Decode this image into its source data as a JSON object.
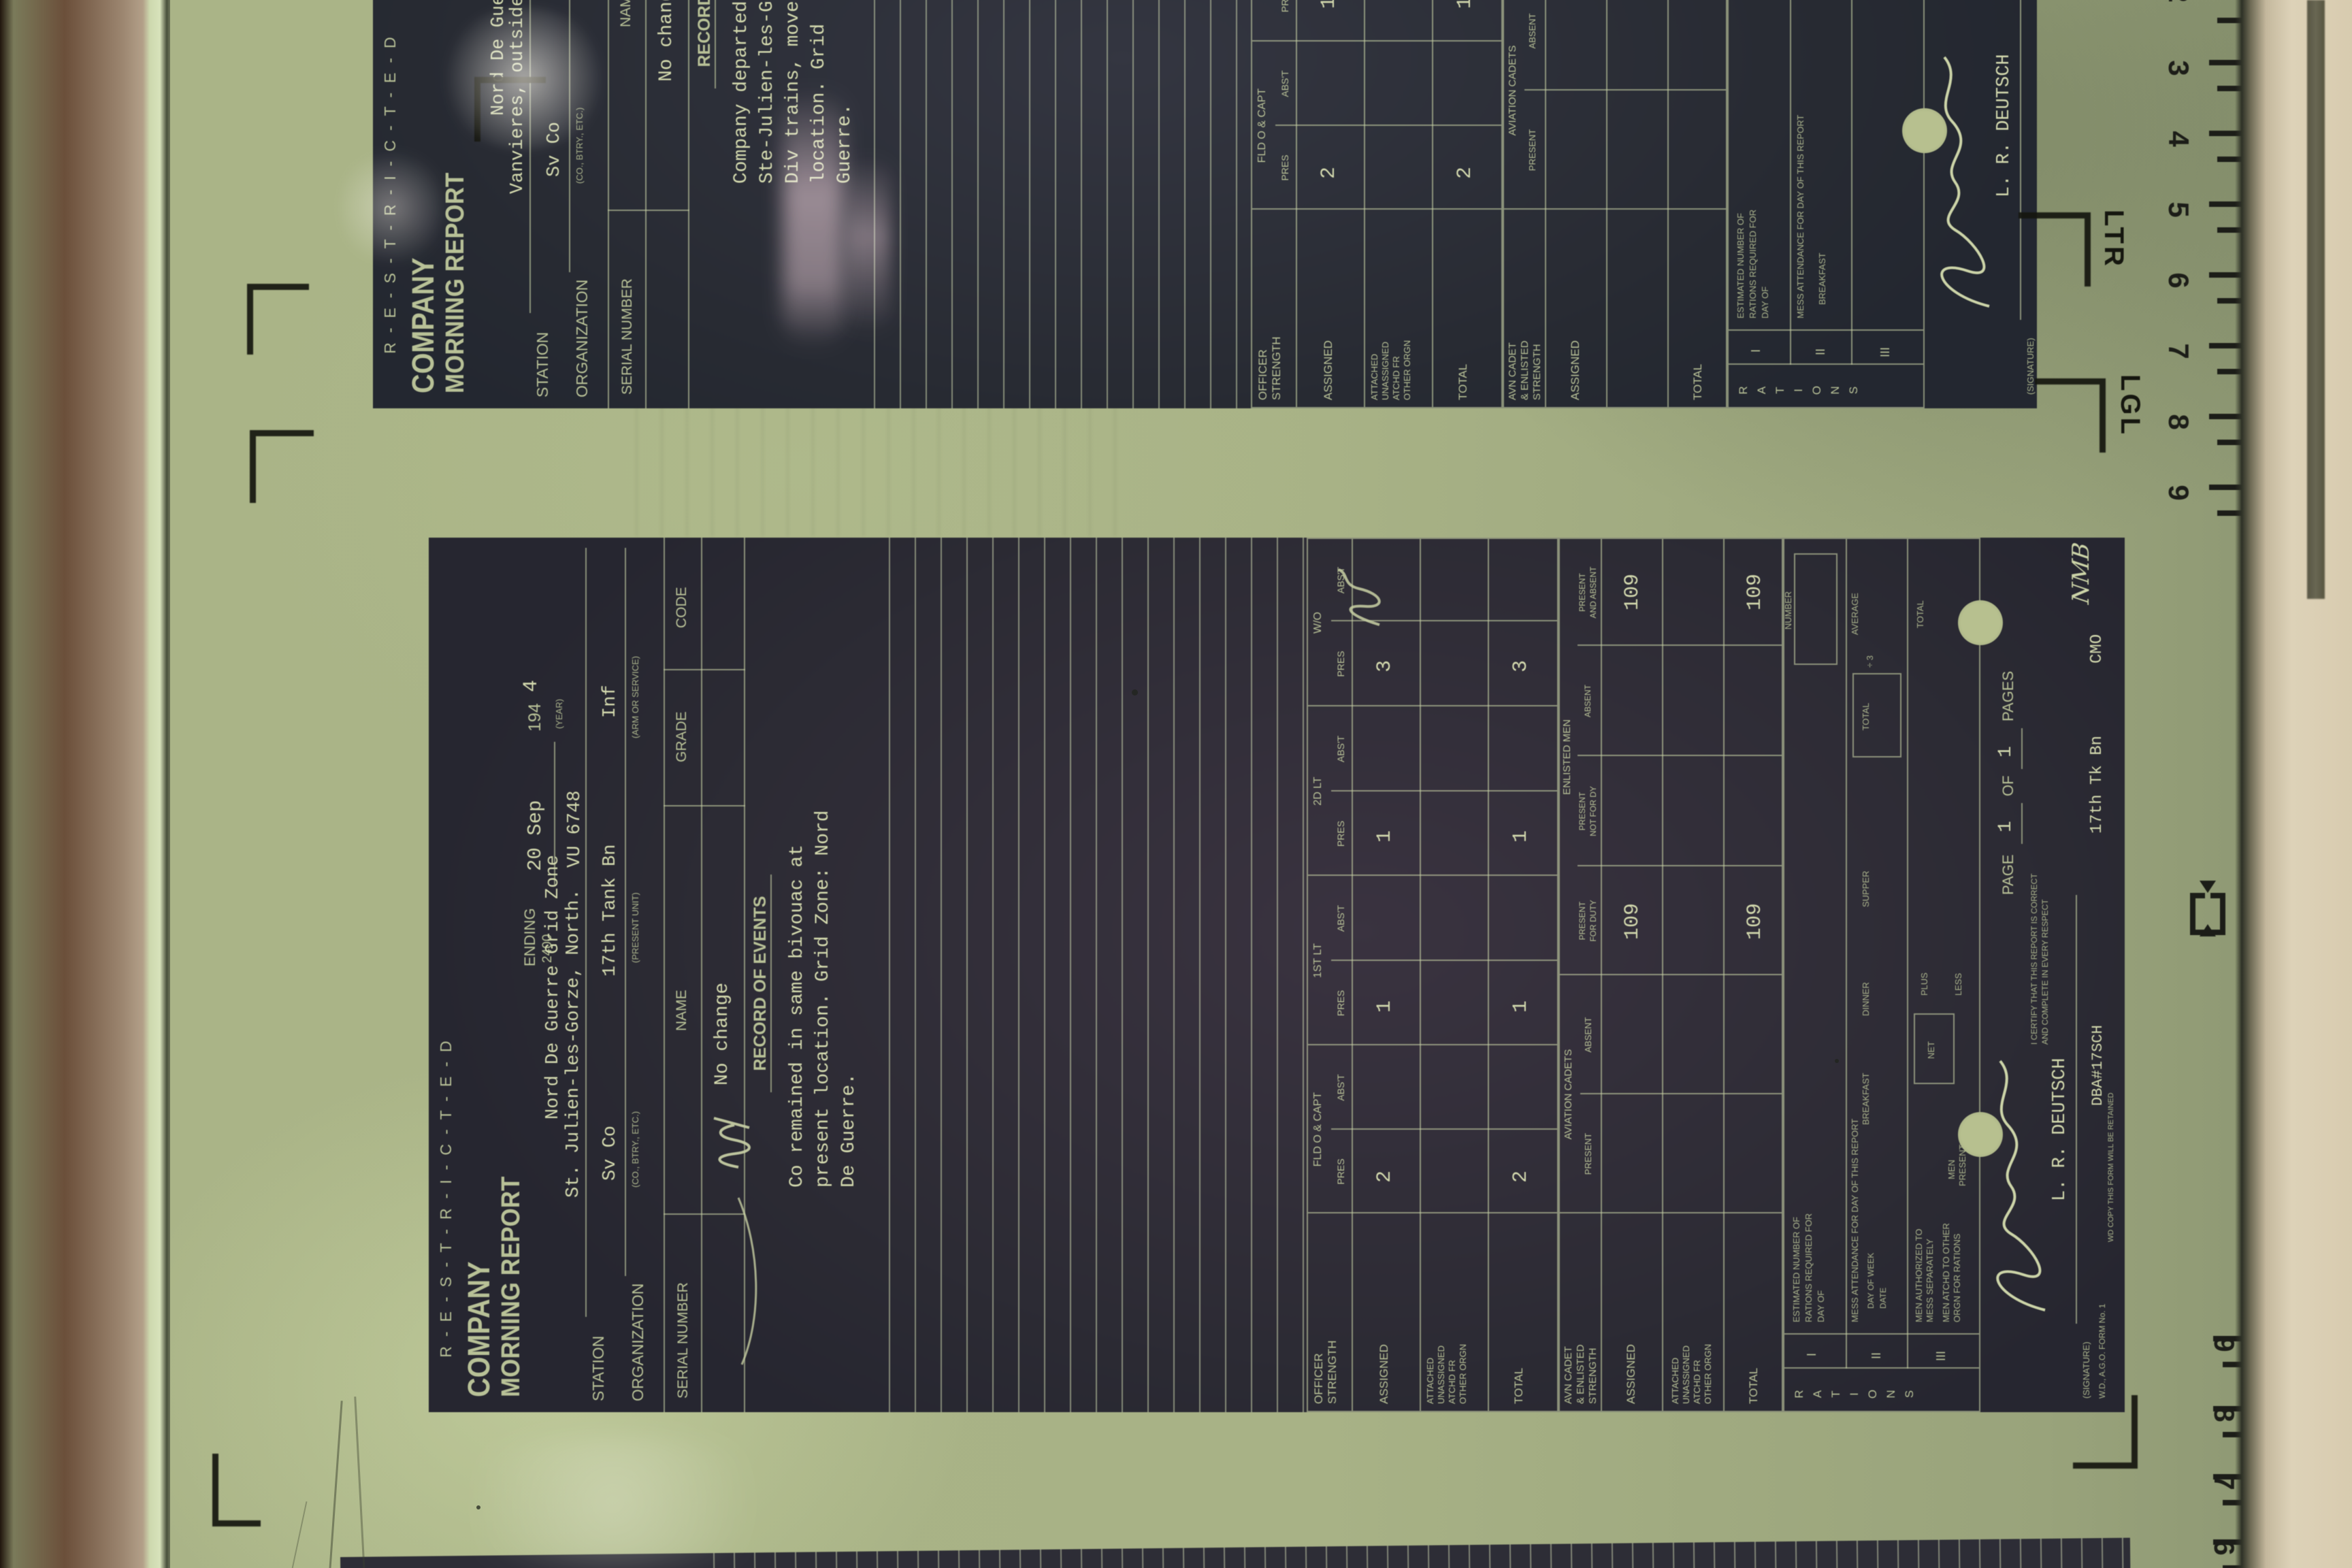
{
  "viewer": {
    "ruler": {
      "ltr": "LTR",
      "lgl": "LGL",
      "top_numbers": [
        "2",
        "3",
        "4",
        "5",
        "6",
        "7",
        "8",
        "9"
      ],
      "bottom_numbers": [
        "9",
        "8",
        "7",
        "6"
      ]
    }
  },
  "form_labels": {
    "restricted": "R-E-S-T-R-I-C-T-E-D",
    "title1": "COMPANY",
    "title2": "MORNING REPORT",
    "ending": "ENDING",
    "time2400": "2400",
    "year194": "194",
    "yearcap": "(YEAR)",
    "station": "STATION",
    "organization": "ORGANIZATION",
    "cap_co": "(CO., BTRY., ETC.)",
    "cap_unit": "(PRESENT UNIT)",
    "cap_arm": "(ARM OR SERVICE)",
    "serial": "SERIAL NUMBER",
    "name": "NAME",
    "grade": "GRADE",
    "code": "CODE",
    "events": "RECORD OF EVENTS",
    "off_g1": "OFFICER",
    "off_g2": "STRENGTH",
    "col_fld": "FLD O & CAPT",
    "col_1lt": "1ST LT",
    "col_2lt": "2D LT",
    "col_wo": "W/O",
    "pres": "PRES",
    "abst": "ABS'T",
    "assigned": "ASSIGNED",
    "att1": "ATTACHED",
    "att2": "UNASSIGNED",
    "att3": "ATCHD FR",
    "att4": "OTHER ORGN",
    "total": "TOTAL",
    "avn_g1": "AVN CADET",
    "avn_g2": "& ENLISTED",
    "avn_g3": "STRENGTH",
    "avncadets": "AVIATION CADETS",
    "present": "PRESENT",
    "absent": "ABSENT",
    "enlmen": "ENLISTED MEN",
    "pfd1": "PRESENT",
    "pfd2": "FOR DUTY",
    "pnd1": "PRESENT",
    "pnd2": "NOT FOR DY",
    "paa1": "PRESENT",
    "paa2": "AND ABSENT",
    "rat_side": "RATIONS",
    "rn1": "I",
    "rn2": "II",
    "rn3": "III",
    "r1a": "ESTIMATED NUMBER OF",
    "r1b": "RATIONS REQUIRED FOR",
    "r1c": "DAY OF",
    "number": "NUMBER",
    "r2a": "MESS ATTENDANCE FOR DAY OF THIS REPORT",
    "dow": "DAY OF WEEK",
    "date": "DATE",
    "bkf": "BREAKFAST",
    "din": "DINNER",
    "sup": "SUPPER",
    "div3": "÷ 3",
    "average": "AVERAGE",
    "r3a1": "MEN AUTHORIZED TO",
    "r3a2": "MESS SEPARATELY",
    "r3b1": "MEN ATCHD TO OTHER",
    "r3b2": "ORGN FOR RATIONS",
    "men": "MEN",
    "net": "NET",
    "plus": "PLUS",
    "less": "LESS",
    "page": "PAGE",
    "of": "OF",
    "pages": "PAGES",
    "sigcap": "(SIGNATURE)",
    "cert1": "I CERTIFY THAT THIS REPORT IS CORRECT",
    "cert2": "AND COMPLETE IN EVERY RESPECT",
    "formno": "W.D., A.G.O. FORM No. 1",
    "copynote": "WD COPY  THIS FORM WILL BE RETAINED"
  },
  "doc_center": {
    "date": "20 Sep",
    "year4": "4",
    "gridnote": "Nord De Guerre Grid Zone",
    "gridcode": "VU 6748",
    "station": "St. Julien-les-Gorze, North.",
    "co": "Sv Co",
    "unit": "17th Tank Bn",
    "arm": "Inf",
    "roster": "No change",
    "events": [
      "Co remained in same bivouac at",
      "present location. Grid Zone: Nord",
      "De Guerre."
    ],
    "oa": [
      "2",
      "1",
      "1",
      "3"
    ],
    "ot": [
      "2",
      "1",
      "1",
      "3"
    ],
    "e_apfd": "109",
    "e_apaa": "109",
    "e_tpfd": "109",
    "e_tpaa": "109",
    "pg": "1",
    "pgs": "1",
    "signame": "L. R. DEUTSCH",
    "st1": "DBA#17SCH",
    "st2": "17th Tk Bn",
    "st3": "CMO",
    "init": "NMB"
  },
  "doc_top": {
    "gridnote": "Nord De Guerre Grid Zone",
    "station": "Vanvieres, outside",
    "co": "Sv Co",
    "unit": "17th Tank Bn",
    "roster": "No change",
    "events": [
      "Company departed by",
      "Ste-Julien-les-Gorze,",
      "Div trains, moved",
      "location. Grid",
      "Guerre."
    ],
    "oa": [
      "2",
      "1",
      "1",
      "3"
    ],
    "ot": [
      "2",
      "1",
      "1",
      "3"
    ],
    "signame": "L. R. DEUTSCH"
  }
}
